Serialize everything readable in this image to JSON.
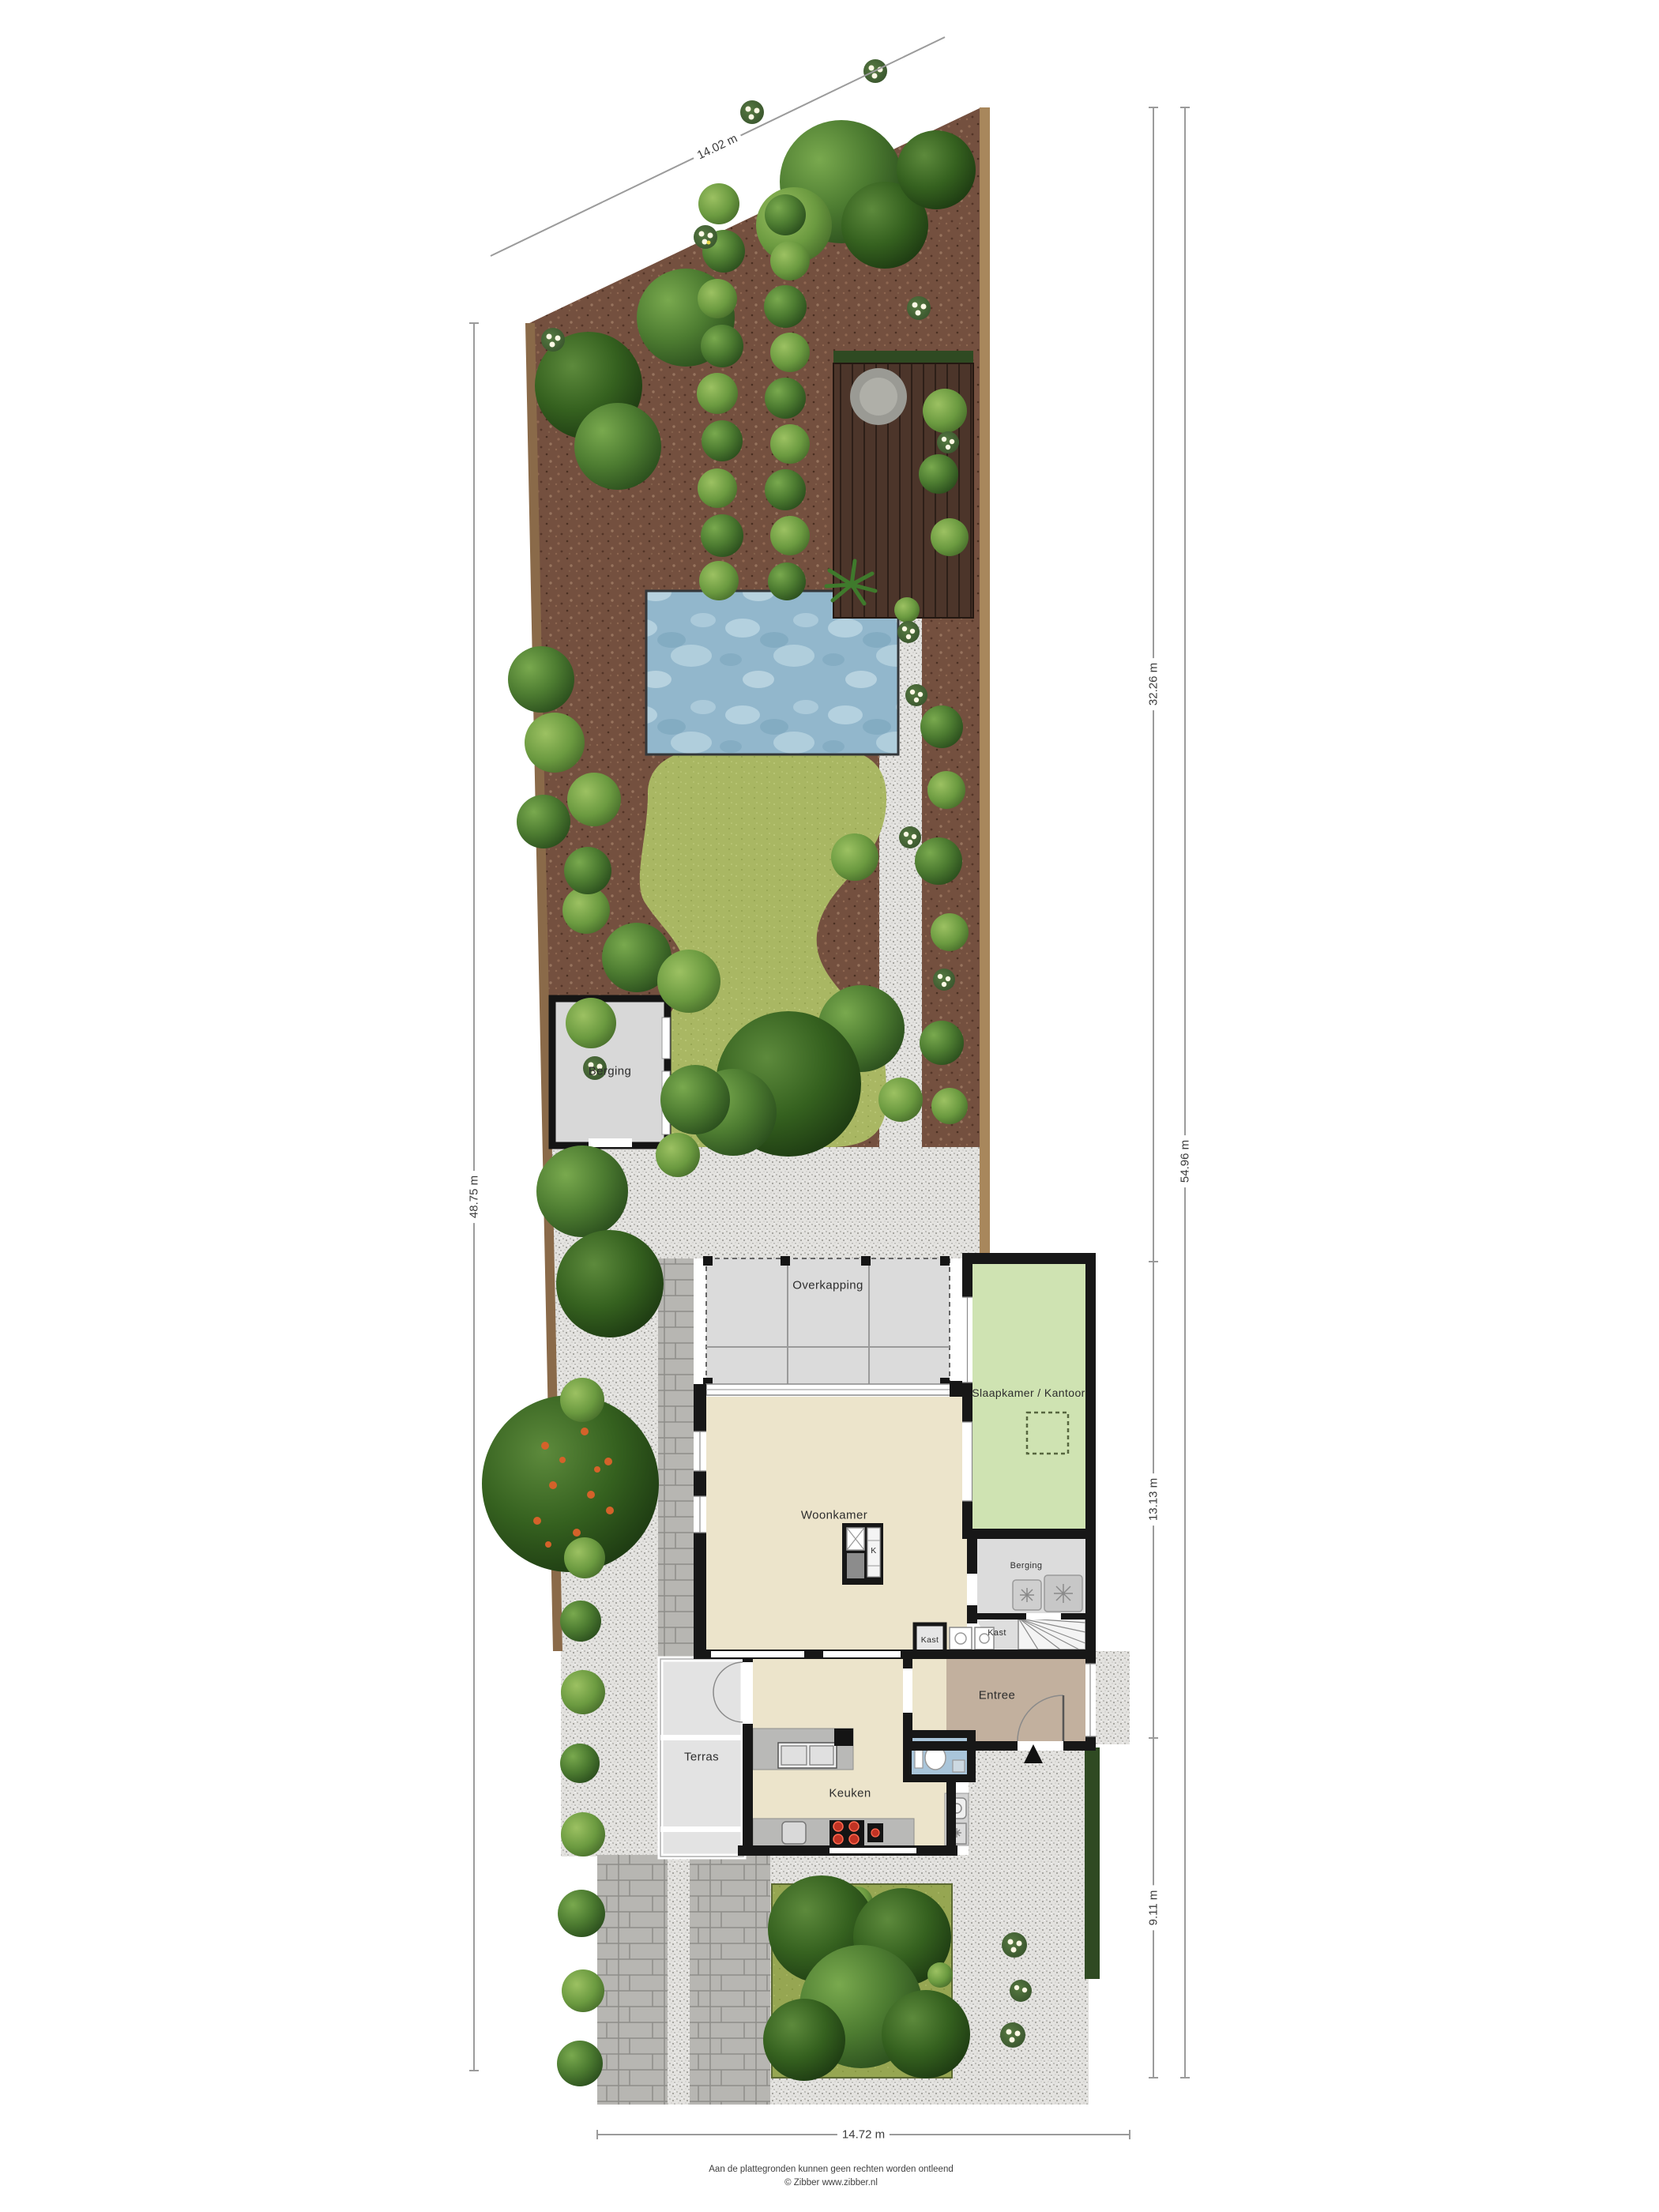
{
  "dimensions": {
    "top": "14.02 m",
    "left": "48.75 m",
    "right_upper": "32.26 m",
    "right_total": "54.96 m",
    "right_middle": "13.13 m",
    "right_lower": "9.11 m",
    "bottom": "14.72 m"
  },
  "rooms": {
    "shed": "Berging",
    "overkapping": "Overkapping",
    "bedroom_office": "Slaapkamer / Kantoor",
    "living": "Woonkamer",
    "storage": "Berging",
    "closet": "Kast",
    "closet_small": "Kast",
    "entry": "Entree",
    "terrace": "Terras",
    "kitchen": "Keuken",
    "kitchen_unit": "K"
  },
  "footer": {
    "disclaimer": "Aan de plattegronden kunnen geen rechten worden ontleend",
    "credit": "© Zibber www.zibber.nl"
  },
  "icons": {
    "north_arrow": "triangle-up"
  },
  "colors": {
    "mulch": "#74503f",
    "gravel": "#e3e2df",
    "grass": "#a9b763",
    "pool": "#92b7cc",
    "deck": "#4c352a",
    "wall": "#171717",
    "floor_beige": "#ece4cb",
    "bedroom_green": "#cfe3b2",
    "entry_brown": "#c2b09e",
    "toilet_blue": "#a9c5da",
    "fence": "#8a6a49"
  }
}
